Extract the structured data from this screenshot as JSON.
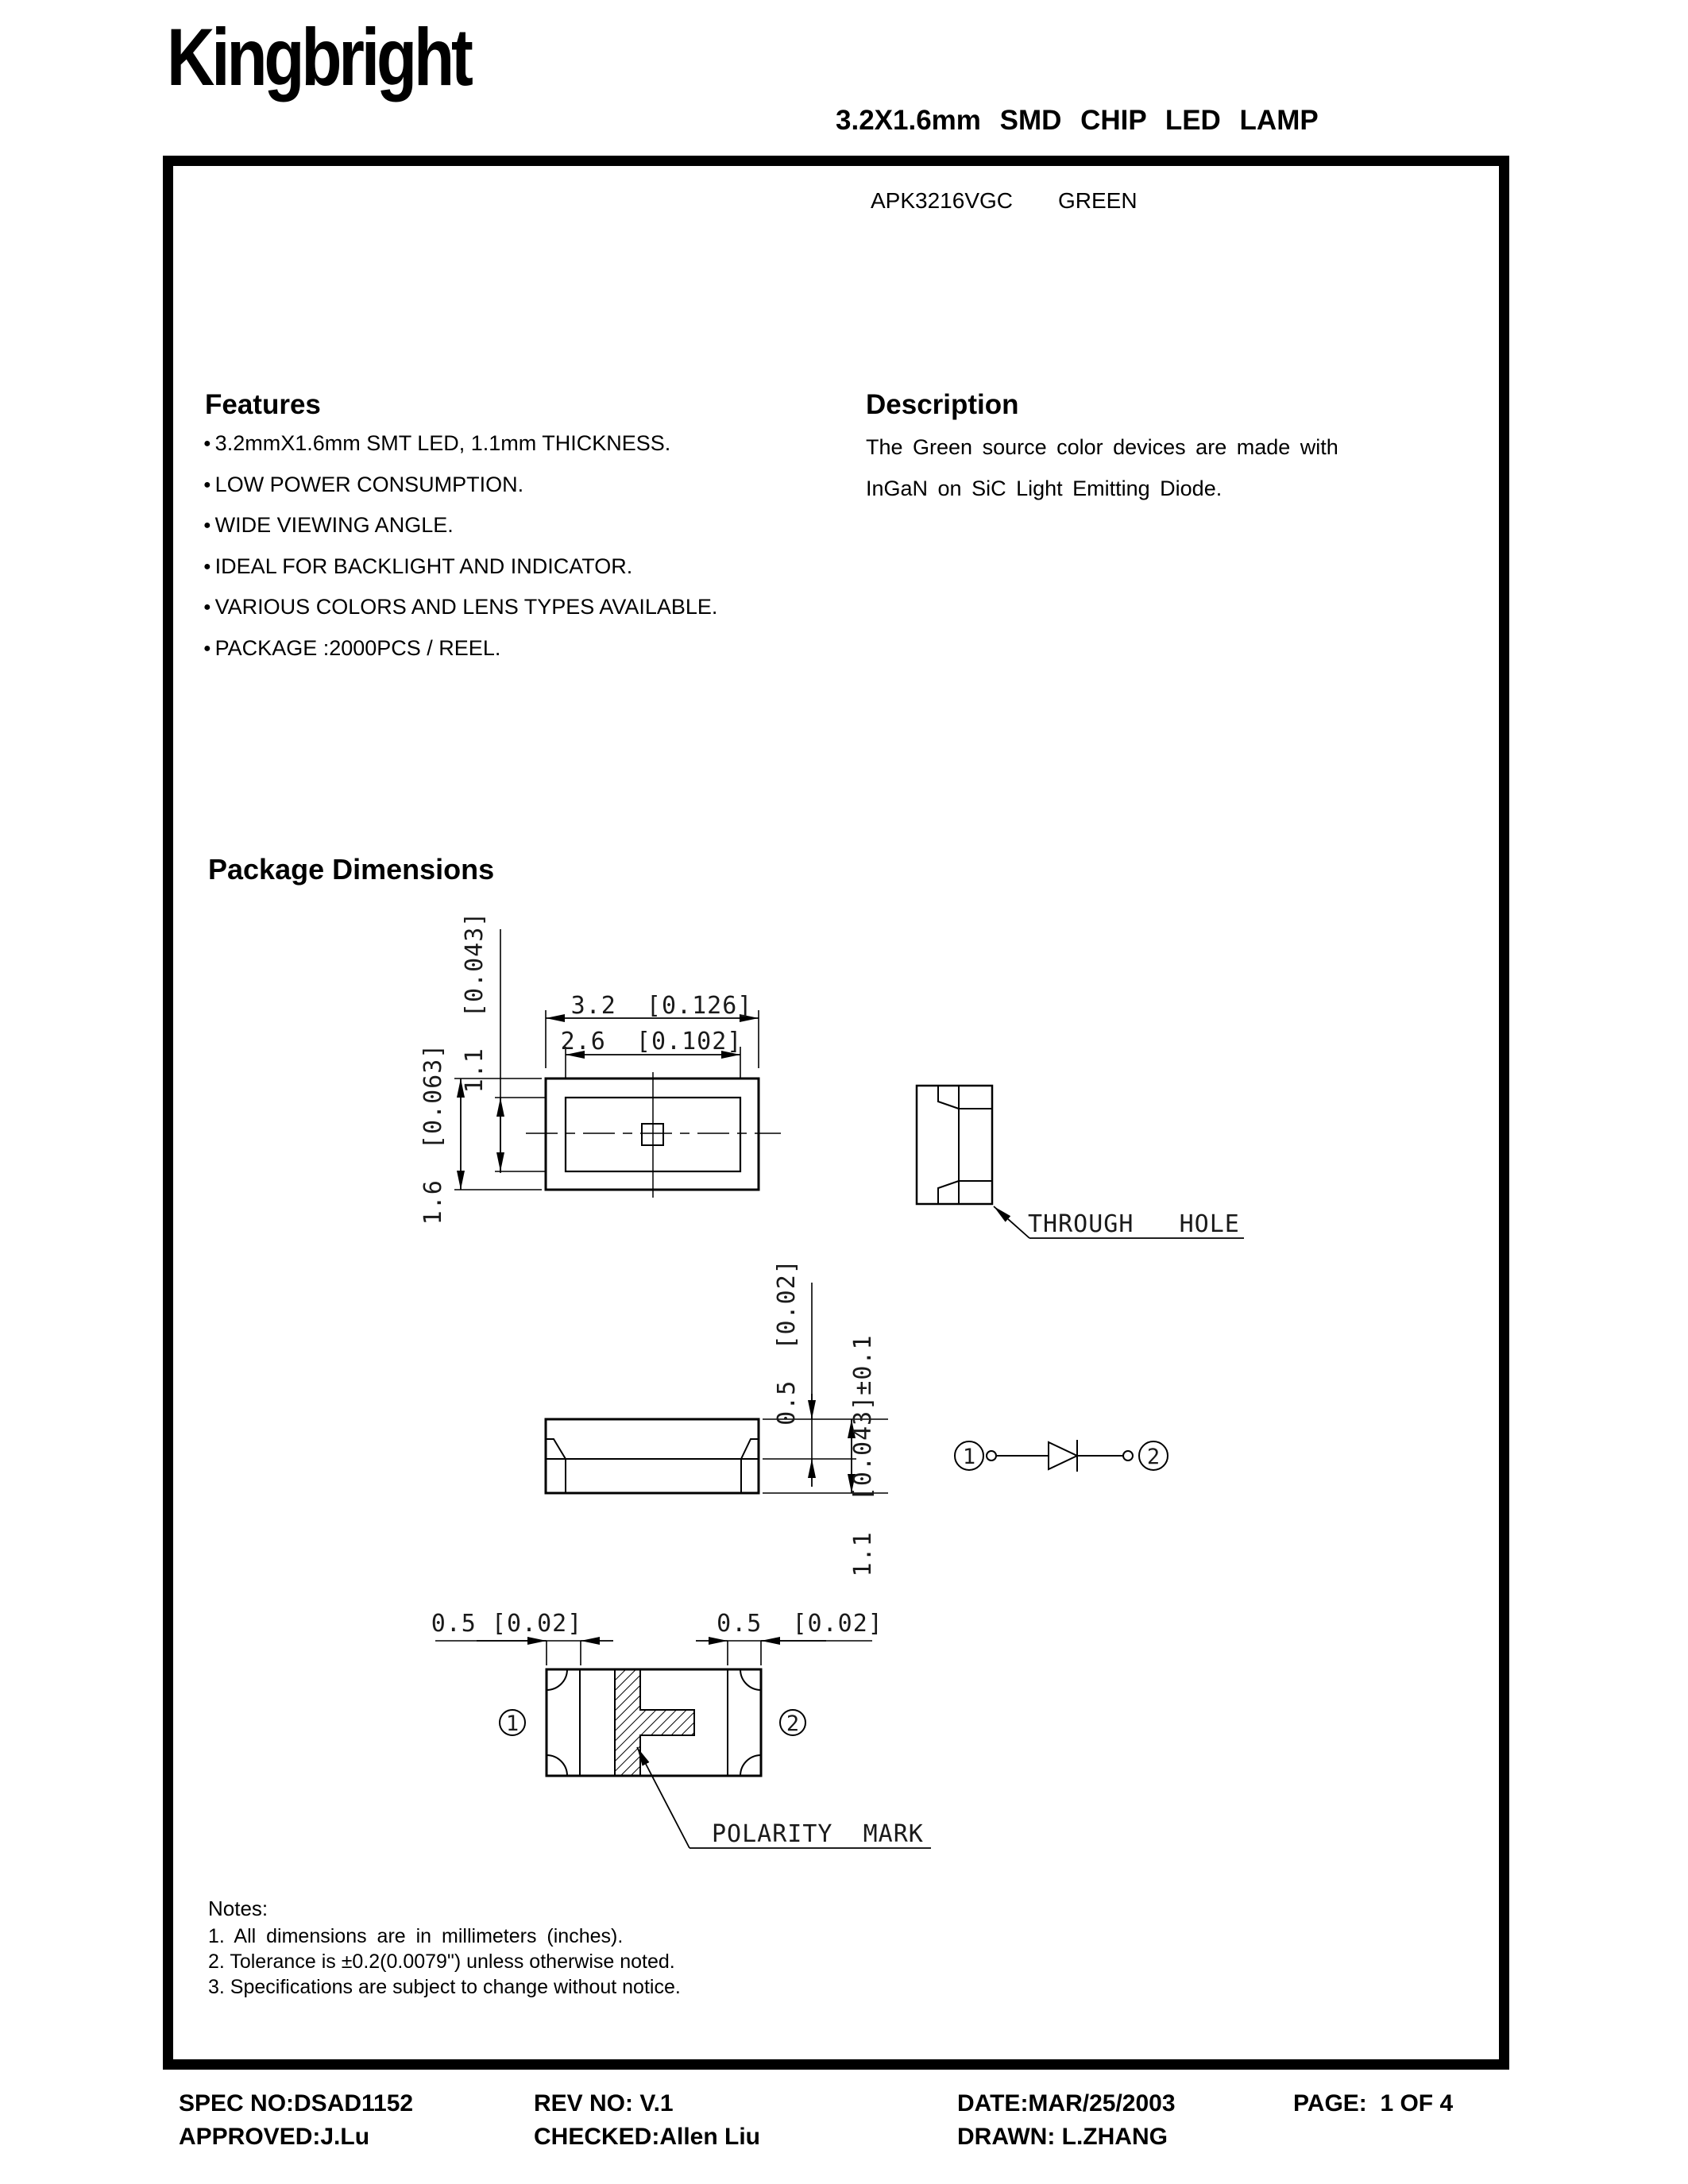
{
  "header": {
    "logo": "Kingbright",
    "title": "3.2X1.6mm SMD CHIP LED LAMP"
  },
  "part": {
    "number": "APK3216VGC",
    "color": "GREEN"
  },
  "features": {
    "heading": "Features",
    "bullet": "●",
    "items": [
      "3.2mmX1.6mm SMT LED, 1.1mm THICKNESS.",
      "LOW POWER CONSUMPTION.",
      "WIDE VIEWING ANGLE.",
      "IDEAL FOR BACKLIGHT AND INDICATOR.",
      "VARIOUS COLORS AND LENS TYPES AVAILABLE.",
      "PACKAGE :2000PCS / REEL."
    ]
  },
  "description": {
    "heading": "Description",
    "line1": "The Green source color devices are made with",
    "line2": "InGaN on SiC Light Emitting Diode."
  },
  "package_dimensions": {
    "heading": "Package Dimensions",
    "dims": {
      "top_width": "3.2  [0.126]",
      "top_inner_width": "2.6  [0.102]",
      "inner_height": "1.1  [0.043]",
      "outer_height": "1.6  [0.063]",
      "side_top": "0.5  [0.02]",
      "side_height": "1.1  [0.043]±0.1",
      "pad_left": "0.5 [0.02]",
      "pad_right": "0.5  [0.02]"
    },
    "labels": {
      "through_hole": "THROUGH   HOLE",
      "polarity_mark": "POLARITY  MARK",
      "pin1": "1",
      "pin2": "2"
    }
  },
  "notes": {
    "heading": "Notes:",
    "items": [
      "1. All dimensions are in millimeters (inches).",
      "2. Tolerance is ±0.2(0.0079\") unless otherwise noted.",
      "3. Specifications are subject to change without notice."
    ]
  },
  "footer": {
    "spec_no": "SPEC NO:DSAD1152",
    "rev_no": "REV NO: V.1",
    "date": "DATE:MAR/25/2003",
    "page": "PAGE:  1 OF 4",
    "approved": "APPROVED:J.Lu",
    "checked": "CHECKED:Allen Liu",
    "drawn": "DRAWN: L.ZHANG"
  }
}
